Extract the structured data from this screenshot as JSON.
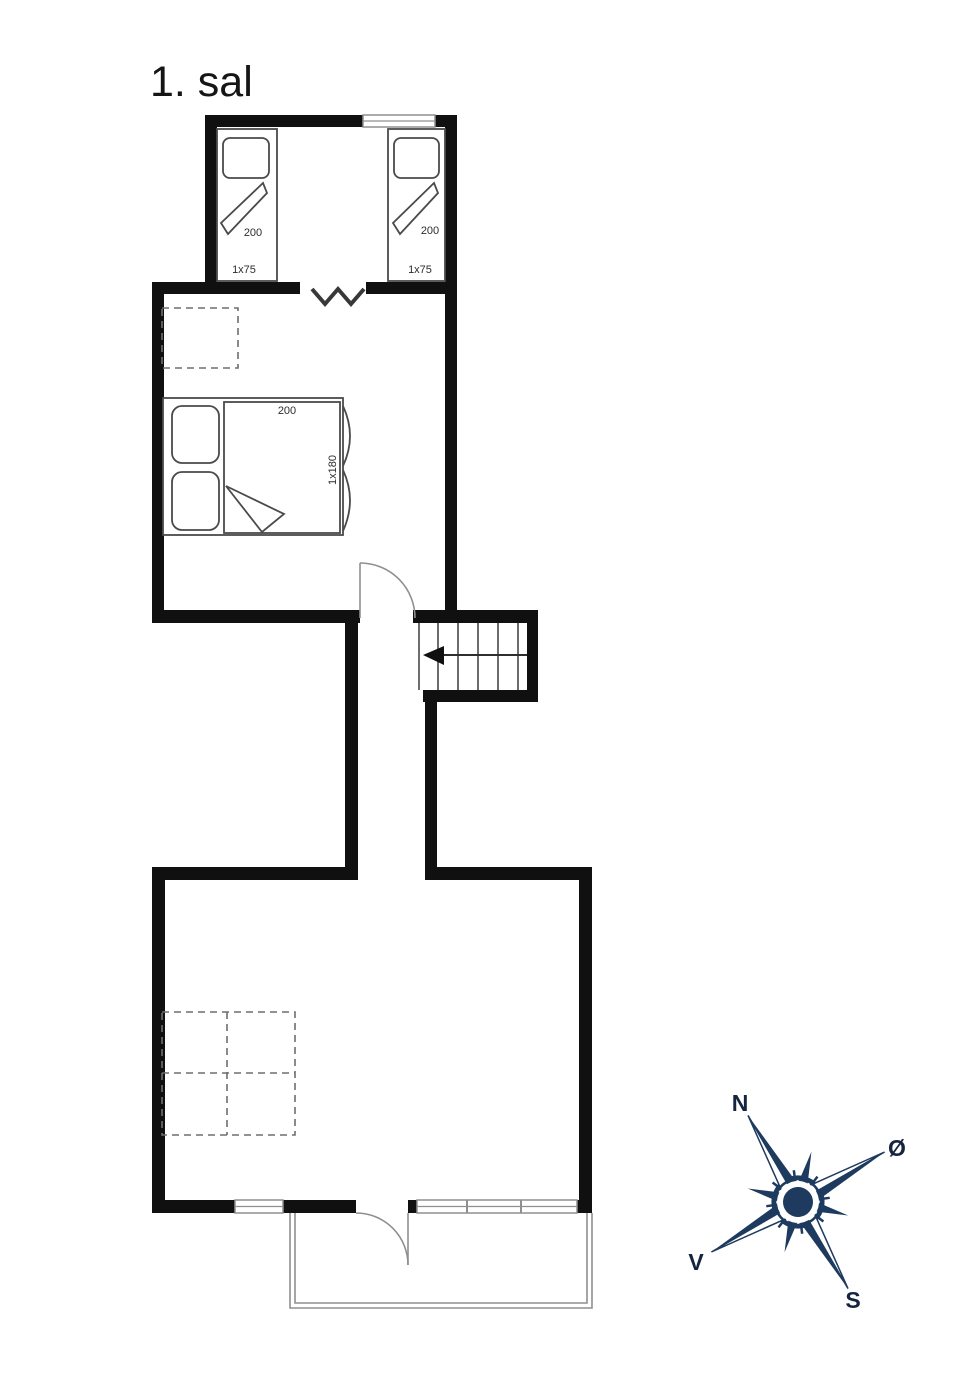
{
  "colors": {
    "bg": "#ffffff",
    "wall": "#101010",
    "thin": "#4a4a4a",
    "light": "#8f8f8f",
    "dash": "#6e6e6e",
    "label": "#2d2d2d",
    "navy": "#1e3a5f",
    "navylabel": "#15253f"
  },
  "plan": {
    "title": "1. sal"
  },
  "upper_bedroom": {
    "bed_left": {
      "length": "200",
      "size": "1x75"
    },
    "bed_right": {
      "length": "200",
      "size": "1x75"
    }
  },
  "master_bedroom": {
    "bed": {
      "length": "200",
      "size": "1x180"
    }
  },
  "compass": {
    "north": "N",
    "east": "Ø",
    "west": "V",
    "south": "S"
  }
}
